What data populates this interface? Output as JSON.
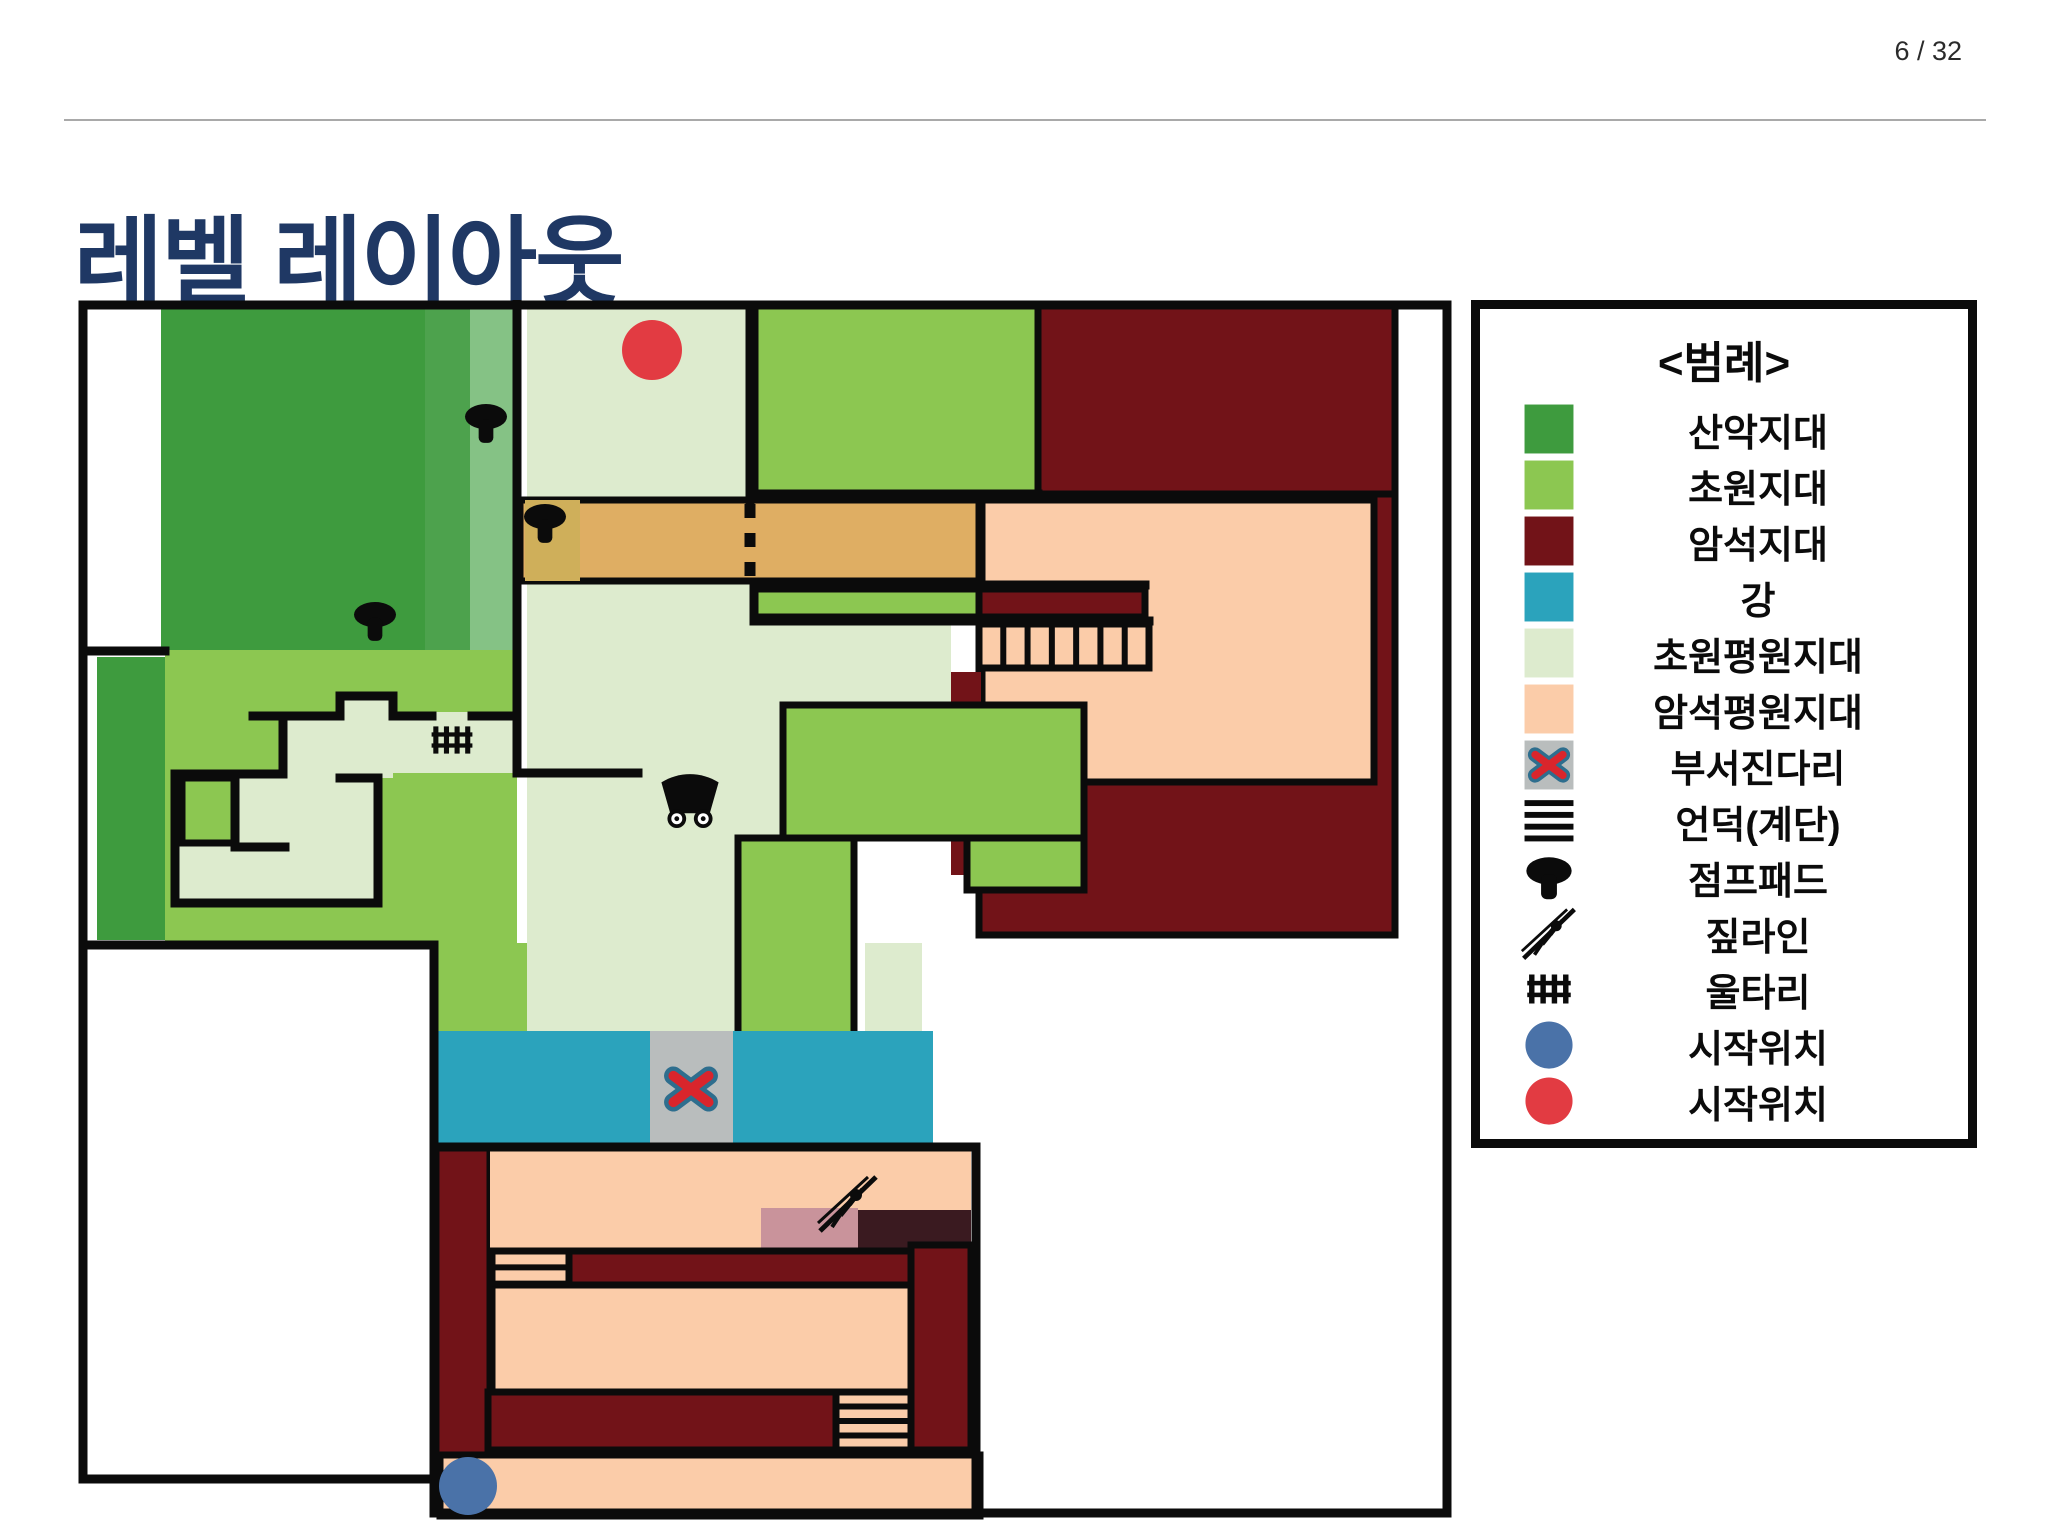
{
  "page": {
    "number_label": "6 / 32"
  },
  "title": {
    "text": "레벨 레이아웃",
    "color": "#1F3864"
  },
  "legend": {
    "title": "<범례>",
    "items": [
      {
        "id": "mountain-zone",
        "label": "산악지대",
        "swatch": "color",
        "color": "#3E9B3E"
      },
      {
        "id": "grass-zone",
        "label": "초원지대",
        "swatch": "color",
        "color": "#8CC751"
      },
      {
        "id": "rock-zone",
        "label": "암석지대",
        "swatch": "color",
        "color": "#721318"
      },
      {
        "id": "river",
        "label": "강",
        "swatch": "color",
        "color": "#2BA3BC"
      },
      {
        "id": "grass-plain-zone",
        "label": "초원평원지대",
        "swatch": "color",
        "color": "#DDEBCE"
      },
      {
        "id": "rock-plain-zone",
        "label": "암석평원지대",
        "swatch": "color",
        "color": "#FBCCA9"
      },
      {
        "id": "broken-bridge",
        "label": "부서진다리",
        "swatch": "bridge",
        "color": "#B9BDBD"
      },
      {
        "id": "hill-stairs",
        "label": "언덕(계단)",
        "swatch": "hill",
        "color": "#0b0b0b"
      },
      {
        "id": "jump-pad",
        "label": "점프패드",
        "swatch": "mushroom",
        "color": "#0b0b0b"
      },
      {
        "id": "zipline",
        "label": "짚라인",
        "swatch": "zipline",
        "color": "#0b0b0b"
      },
      {
        "id": "fence",
        "label": "울타리",
        "swatch": "fence",
        "color": "#0b0b0b"
      },
      {
        "id": "start-position-blue",
        "label": "시작위치",
        "swatch": "circle",
        "color": "#4A72A8"
      },
      {
        "id": "start-position-red",
        "label": "시작위치",
        "swatch": "circle",
        "color": "#E23B42"
      }
    ]
  },
  "map": {
    "view": {
      "w": 1375,
      "h": 1220
    },
    "palette": {
      "mountain": "#3E9B3E",
      "mountainMid": "#4DA24D",
      "mountainSage": "#85C285",
      "grass": "#8CC751",
      "rock": "#721318",
      "river": "#2BA3BC",
      "plainGrass": "#DDEBCE",
      "plainRock": "#FBCCA9",
      "tan": "#DFAE63",
      "tanOlive": "#CFAF5A",
      "bridge": "#B9BDBD",
      "pink": "#C9939B",
      "darkOverlay": "#3A1A20",
      "xRed": "#D9252C",
      "xOutline": "#2E6E8E",
      "startBlue": "#4A72A8",
      "startRed": "#E23B42",
      "wall": "#0B0B0B"
    },
    "regions": [
      {
        "t": "rect",
        "x": 83,
        "y": 6,
        "w": 356,
        "h": 344,
        "f": "mountain"
      },
      {
        "t": "rect",
        "x": 347,
        "y": 6,
        "w": 45,
        "h": 344,
        "f": "mountainMid"
      },
      {
        "t": "rect",
        "x": 392,
        "y": 6,
        "w": 47,
        "h": 344,
        "f": "mountainSage"
      },
      {
        "t": "rect",
        "x": 87,
        "y": 350,
        "w": 352,
        "h": 293,
        "f": "grass"
      },
      {
        "t": "rect",
        "x": 19,
        "y": 357,
        "w": 68,
        "h": 283,
        "f": "mountain"
      },
      {
        "t": "rect",
        "x": 358,
        "y": 643,
        "w": 197,
        "h": 92,
        "f": "grass"
      },
      {
        "t": "rect",
        "x": 449,
        "y": 6,
        "w": 228,
        "h": 275,
        "f": "plainGrass"
      },
      {
        "t": "rect",
        "x": 449,
        "y": 281,
        "w": 228,
        "h": 36,
        "f": "plainGrass"
      },
      {
        "t": "rect",
        "x": 449,
        "y": 317,
        "w": 424,
        "h": 88,
        "f": "plainGrass"
      },
      {
        "t": "rect",
        "x": 449,
        "y": 405,
        "w": 256,
        "h": 326,
        "f": "plainGrass"
      },
      {
        "t": "rect",
        "x": 787,
        "y": 643,
        "w": 57,
        "h": 92,
        "f": "plainGrass"
      },
      {
        "t": "rect",
        "x": 97,
        "y": 474,
        "w": 203,
        "h": 129,
        "f": "plainGrass"
      },
      {
        "t": "rect",
        "x": 205,
        "y": 412,
        "w": 57,
        "h": 66,
        "f": "plainGrass"
      },
      {
        "t": "rect",
        "x": 262,
        "y": 392,
        "w": 53,
        "h": 86,
        "f": "plainGrass"
      },
      {
        "t": "rect",
        "x": 315,
        "y": 412,
        "w": 124,
        "h": 61,
        "f": "plainGrass"
      },
      {
        "t": "rect",
        "x": 104,
        "y": 478,
        "w": 53,
        "h": 65,
        "f": "grass",
        "s": 1
      },
      {
        "t": "rect",
        "x": 901,
        "y": 194,
        "w": 416,
        "h": 441,
        "f": "rock",
        "s": 1
      },
      {
        "t": "rect",
        "x": 904,
        "y": 200,
        "w": 392,
        "h": 282,
        "f": "plainRock",
        "s": 1
      },
      {
        "t": "rect",
        "x": 442,
        "y": 200,
        "w": 459,
        "h": 81,
        "f": "tan",
        "s": 1
      },
      {
        "t": "rect",
        "x": 447,
        "y": 200,
        "w": 55,
        "h": 81,
        "f": "tanOlive"
      },
      {
        "t": "rect",
        "x": 677,
        "y": 6,
        "w": 283,
        "h": 188,
        "f": "grass",
        "s": 1
      },
      {
        "t": "rect",
        "x": 960,
        "y": 6,
        "w": 357,
        "h": 188,
        "f": "rock",
        "s": 1
      },
      {
        "t": "rect",
        "x": 676,
        "y": 289,
        "w": 225,
        "h": 28,
        "f": "grass",
        "s": 1
      },
      {
        "t": "rect",
        "x": 901,
        "y": 289,
        "w": 166,
        "h": 28,
        "f": "rock",
        "s": 1
      },
      {
        "t": "rect",
        "x": 901,
        "y": 324,
        "w": 170,
        "h": 44,
        "f": "plainRock",
        "s": 1
      },
      {
        "t": "rect",
        "x": 873,
        "y": 372,
        "w": 30,
        "h": 203,
        "f": "rock"
      },
      {
        "t": "rect",
        "x": 705,
        "y": 405,
        "w": 301,
        "h": 133,
        "f": "grass",
        "s": 1
      },
      {
        "t": "rect",
        "x": 889,
        "y": 538,
        "w": 117,
        "h": 52,
        "f": "grass",
        "s": 1
      },
      {
        "t": "rect",
        "x": 660,
        "y": 538,
        "w": 116,
        "h": 197,
        "f": "grass",
        "s": 1
      },
      {
        "t": "rect",
        "x": 358,
        "y": 731,
        "w": 497,
        "h": 116,
        "f": "river"
      },
      {
        "t": "rect",
        "x": 572,
        "y": 731,
        "w": 83,
        "h": 116,
        "f": "bridge"
      },
      {
        "t": "rect",
        "x": 358,
        "y": 847,
        "w": 54,
        "h": 308,
        "f": "rock",
        "s": 1
      },
      {
        "t": "rect",
        "x": 412,
        "y": 847,
        "w": 481,
        "h": 104,
        "f": "plainRock"
      },
      {
        "t": "rect",
        "x": 683,
        "y": 908,
        "w": 97,
        "h": 43,
        "f": "pink"
      },
      {
        "t": "rect",
        "x": 780,
        "y": 910,
        "w": 113,
        "h": 41,
        "f": "darkOverlay"
      },
      {
        "t": "rect",
        "x": 414,
        "y": 951,
        "w": 77,
        "h": 49,
        "f": "plainRock",
        "s": 1
      },
      {
        "t": "rect",
        "x": 491,
        "y": 951,
        "w": 402,
        "h": 34,
        "f": "rock",
        "s": 1
      },
      {
        "t": "rect",
        "x": 414,
        "y": 985,
        "w": 419,
        "h": 107,
        "f": "plainRock",
        "s": 1
      },
      {
        "t": "rect",
        "x": 833,
        "y": 945,
        "w": 60,
        "h": 205,
        "f": "rock",
        "s": 1
      },
      {
        "t": "rect",
        "x": 410,
        "y": 1092,
        "w": 348,
        "h": 58,
        "f": "rock",
        "s": 1
      },
      {
        "t": "rect",
        "x": 758,
        "y": 1092,
        "w": 75,
        "h": 58,
        "f": "plainRock",
        "s": 1
      },
      {
        "t": "rect",
        "x": 362,
        "y": 1155,
        "w": 540,
        "h": 61,
        "f": "plainRock",
        "s": 1
      }
    ],
    "walls": [
      "M5,5 H1369 V1213 H356 V1179 H5 Z",
      "M439,4 V412",
      "M175,416 H262 V396 H315 V416 H354",
      "M394,416 H439 V473 H560",
      "M97,474 H205 V416",
      "M97,474 V603 H300 V478 H262",
      "M157,478 V547 H207",
      "M5,351 H87",
      "M5,645 H356",
      "M356,645 V1179",
      "M898,847 V1213",
      "M358,847 H898",
      "M677,194 H960",
      "M672,6 V200",
      "M676,285 H1067",
      "M676,321 H1071",
      "M676,285 V321"
    ],
    "stairs": [
      {
        "t": "stairs-v",
        "x": 901,
        "y": 324,
        "w": 170,
        "h": 44,
        "n": 6
      },
      {
        "t": "stairs-h",
        "x": 414,
        "y": 951,
        "w": 77,
        "h": 49,
        "n": 2
      },
      {
        "t": "stairs-h",
        "x": 758,
        "y": 1092,
        "w": 75,
        "h": 58,
        "n": 3
      }
    ],
    "dotted_border": {
      "x": 672,
      "y1": 204,
      "y2": 283
    },
    "icons": {
      "mushrooms": [
        {
          "x": 408,
          "y": 124
        },
        {
          "x": 467,
          "y": 224
        },
        {
          "x": 297,
          "y": 322
        }
      ],
      "fence": {
        "x": 374,
        "y": 440
      },
      "wagon": {
        "x": 612,
        "y": 500
      },
      "zipline": {
        "x": 770,
        "y": 903
      },
      "bridge_x": {
        "x": 613,
        "y": 789
      },
      "start_red": {
        "x": 574,
        "y": 50,
        "r": 30
      },
      "start_blue": {
        "x": 390,
        "y": 1186,
        "r": 29
      }
    }
  }
}
